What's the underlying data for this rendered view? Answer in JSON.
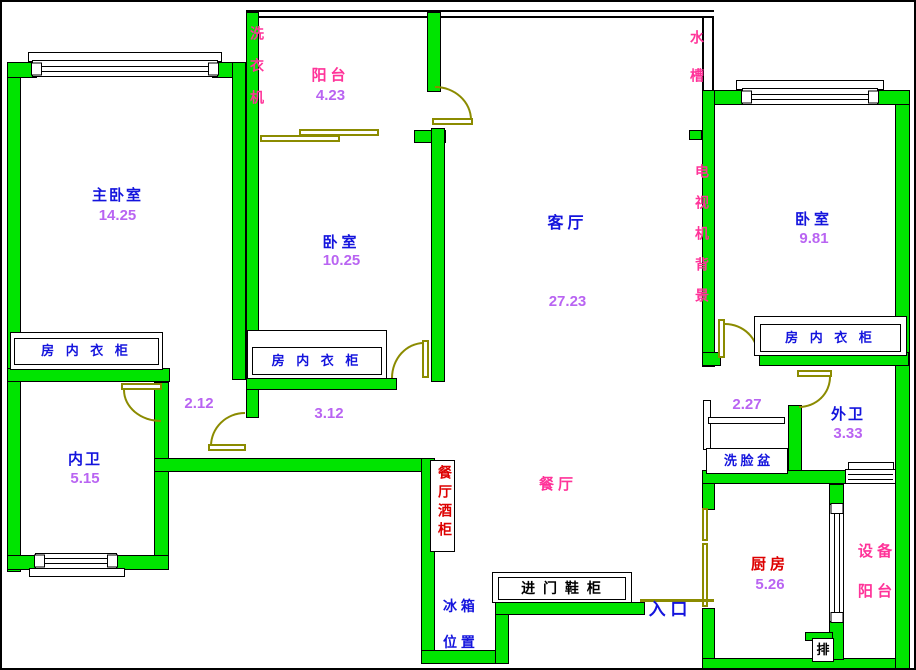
{
  "rooms": {
    "master_bedroom": {
      "label": "主卧室",
      "area": "14.25"
    },
    "bedroom_middle": {
      "label": "卧室",
      "area": "10.25"
    },
    "bedroom_right": {
      "label": "卧室",
      "area": "9.81"
    },
    "living_room": {
      "label": "客厅",
      "area": "27.23"
    },
    "balcony": {
      "label": "阳台",
      "area": "4.23"
    },
    "inner_bathroom": {
      "label": "内卫",
      "area": "5.15"
    },
    "outer_bathroom": {
      "label": "外卫",
      "area": "3.33"
    },
    "kitchen": {
      "label": "厨房",
      "area": "5.26"
    },
    "dining_room": {
      "label": "餐厅"
    },
    "equipment_balcony": {
      "line1": "设 备",
      "line2": "阳 台"
    }
  },
  "hall_measurements": {
    "left_hall": "2.12",
    "middle_corridor": "3.12",
    "right_hall": "2.27"
  },
  "fixtures": {
    "washing_machine": "洗衣机",
    "water_sink": "水槽",
    "tv_background": "电视机背景",
    "wardrobe": "房 内 衣 柜",
    "wine_cabinet": "餐厅酒柜",
    "wash_basin": "洗 脸 盆",
    "fridge_line1": "冰 箱",
    "fridge_line2": "位 置",
    "shoe_cabinet": "进 门 鞋 柜",
    "entrance": "入 口",
    "exhaust": "排"
  },
  "colors": {
    "wall_fill": "#00e400",
    "door": "#8b8b00",
    "room_label_blue": "#1414dd",
    "area_value_purple": "#b964f2",
    "fixture_pink": "#ff3399",
    "fixture_red": "#dd0000",
    "cabinet_text_black": "#000000"
  }
}
